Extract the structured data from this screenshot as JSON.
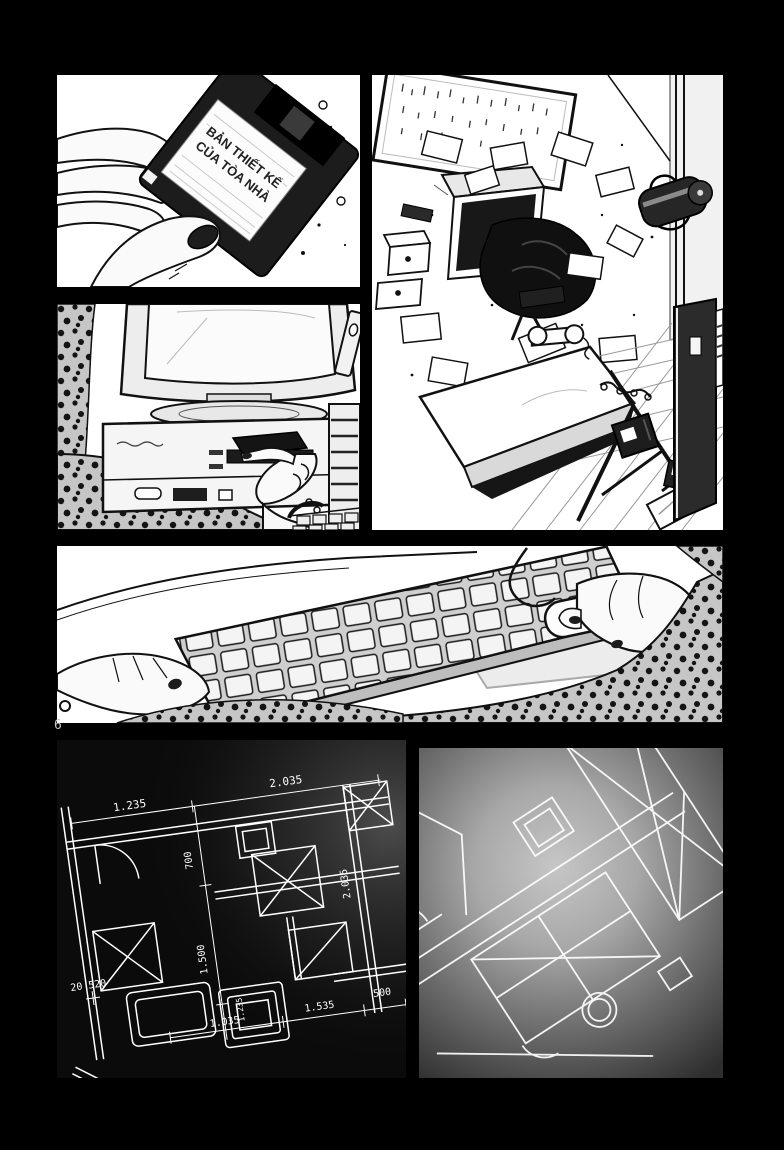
{
  "page": {
    "number": "6",
    "background_color": "#000000"
  },
  "panels": {
    "floppy": {
      "label_line1": "BẢN THIẾT KẾ",
      "label_line2": "CỦA TÒA NHÀ"
    },
    "blueprint": {
      "labels": [
        "1.235",
        "2.035",
        "700",
        "1.500",
        "2.035",
        "20 520",
        "1.235",
        "1.035",
        "1.535",
        "500"
      ],
      "line_color": "#ffffff",
      "bg_color": "#0b0b0b"
    },
    "screen_blueprint": {
      "line_color": "#ffffff",
      "glow_color": "#c6c6c6"
    }
  },
  "colors": {
    "ink": "#111111",
    "paper": "#ffffff",
    "leopard_base": "#c6c6c6"
  }
}
